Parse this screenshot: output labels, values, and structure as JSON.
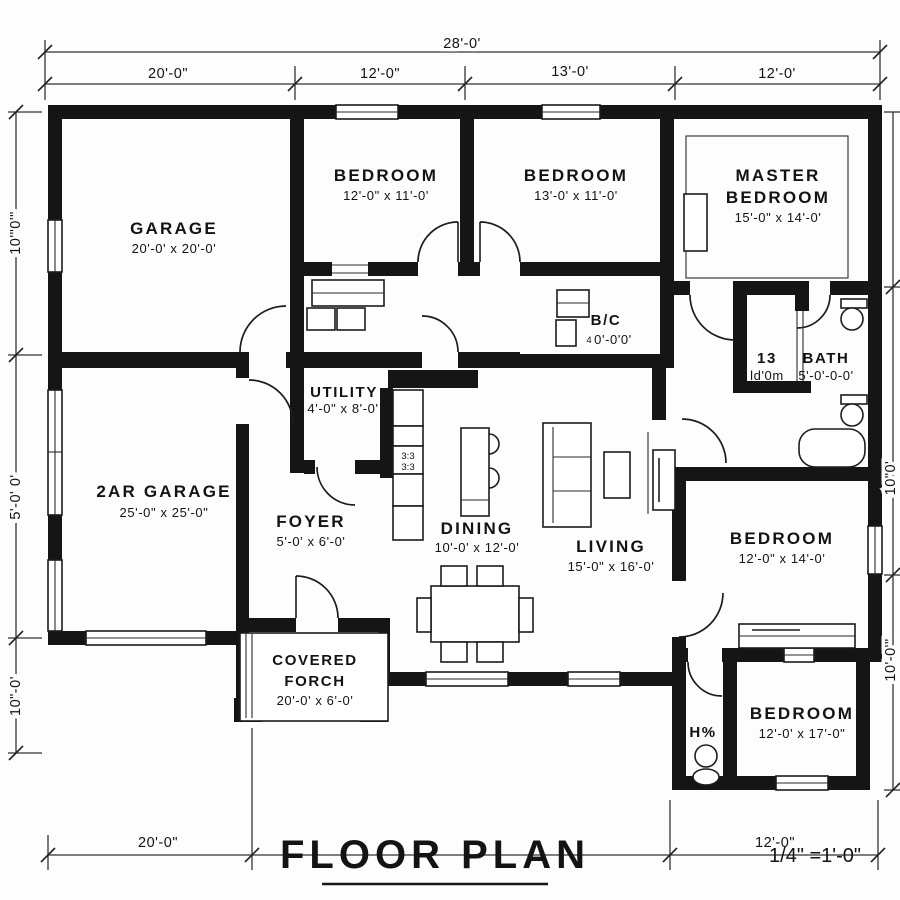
{
  "title": {
    "text": "FLOOR PLAN",
    "scale": "1/4\" =1'-0\""
  },
  "dims": {
    "overall_top": "28'-0'",
    "top": [
      "20'-0\"",
      "12'-0\"",
      "13'-0'",
      "12'-0'"
    ],
    "bottom": [
      "20'-0\"",
      "12'-0\""
    ],
    "left": [
      "10'\"0'\"",
      "5'-0' 0'",
      "10\"-0'"
    ],
    "right": [
      "10\"0'",
      "10'-0'\""
    ]
  },
  "rooms": {
    "garage": {
      "name": "GARAGE",
      "dims": "20'-0' x 20'-0'"
    },
    "bedroom1": {
      "name": "BEDROOM",
      "dims": "12'-0\" x 11'-0'"
    },
    "bedroom2": {
      "name": "BEDROOM",
      "dims": "13'-0' x 11'-0'"
    },
    "master": {
      "name1": "MASTER",
      "name2": "BEDROOM",
      "dims": "15'-0\" x 14'-0'"
    },
    "garage2": {
      "name": "2AR GARAGE",
      "dims": "25'-0\" x 25'-0\""
    },
    "utility": {
      "name": "UTILITY",
      "dims": "4'-0\" x 8'-0'"
    },
    "foyer": {
      "name": "FOYER",
      "dims": "5'-0' x 6'-0'"
    },
    "dining": {
      "name": "DINING",
      "dims": "10'-0' x 12'-0'"
    },
    "living": {
      "name": "LIVING",
      "dims": "15'-0\" x 16'-0'"
    },
    "bc": {
      "name": "B/C",
      "note": "4",
      "dims": "0'-0'0'"
    },
    "closet13": {
      "name": "13",
      "dims": "ld'0m"
    },
    "bath": {
      "name": "BATH",
      "dims": "5'-0'-0-0'"
    },
    "bedroom3": {
      "name": "BEDROOM",
      "dims": "12'-0\" x 14'-0'"
    },
    "bedroom4": {
      "name": "BEDROOM",
      "dims": "12'-0' x 17'-0\""
    },
    "halfbath": {
      "name": "H%"
    },
    "porch": {
      "name1": "COVERED",
      "name2": "FORCH",
      "dims": "20'-0' x 6'-0'"
    },
    "stove": {
      "l1": "3:3",
      "l2": "3:3"
    }
  }
}
